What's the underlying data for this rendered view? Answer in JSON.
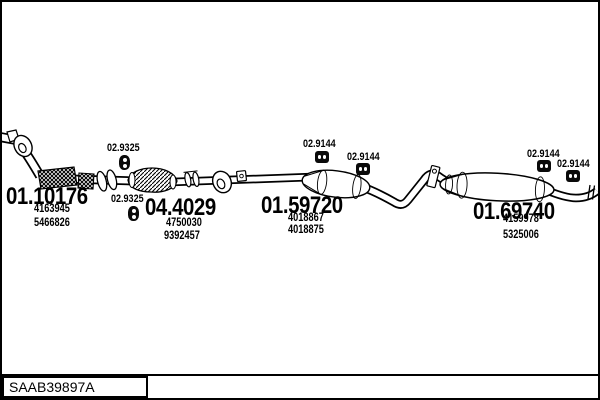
{
  "colors": {
    "ink": "#000000",
    "paper": "#ffffff"
  },
  "footer": {
    "catalog_code": "SAAB39897A"
  },
  "icons": {
    "rubber_grommet": "figure-8 rubber hanger grommet",
    "rubber_mount": "two-hole rubber mount block"
  },
  "parts": {
    "front_pipe": {
      "label": "01.10176",
      "oem1": "4163945",
      "oem2": "5466826"
    },
    "grommet": {
      "label": "02.9325"
    },
    "catalyst": {
      "label": "04.4029",
      "oem1": "4750030",
      "oem2": "9392457"
    },
    "mid_silencer": {
      "label": "01.59720",
      "oem1": "4018867",
      "oem2": "4018875"
    },
    "mount": {
      "label": "02.9144"
    },
    "rear_silencer": {
      "label": "01.69740",
      "oem1": "4159978",
      "oem2": "5325006"
    }
  }
}
